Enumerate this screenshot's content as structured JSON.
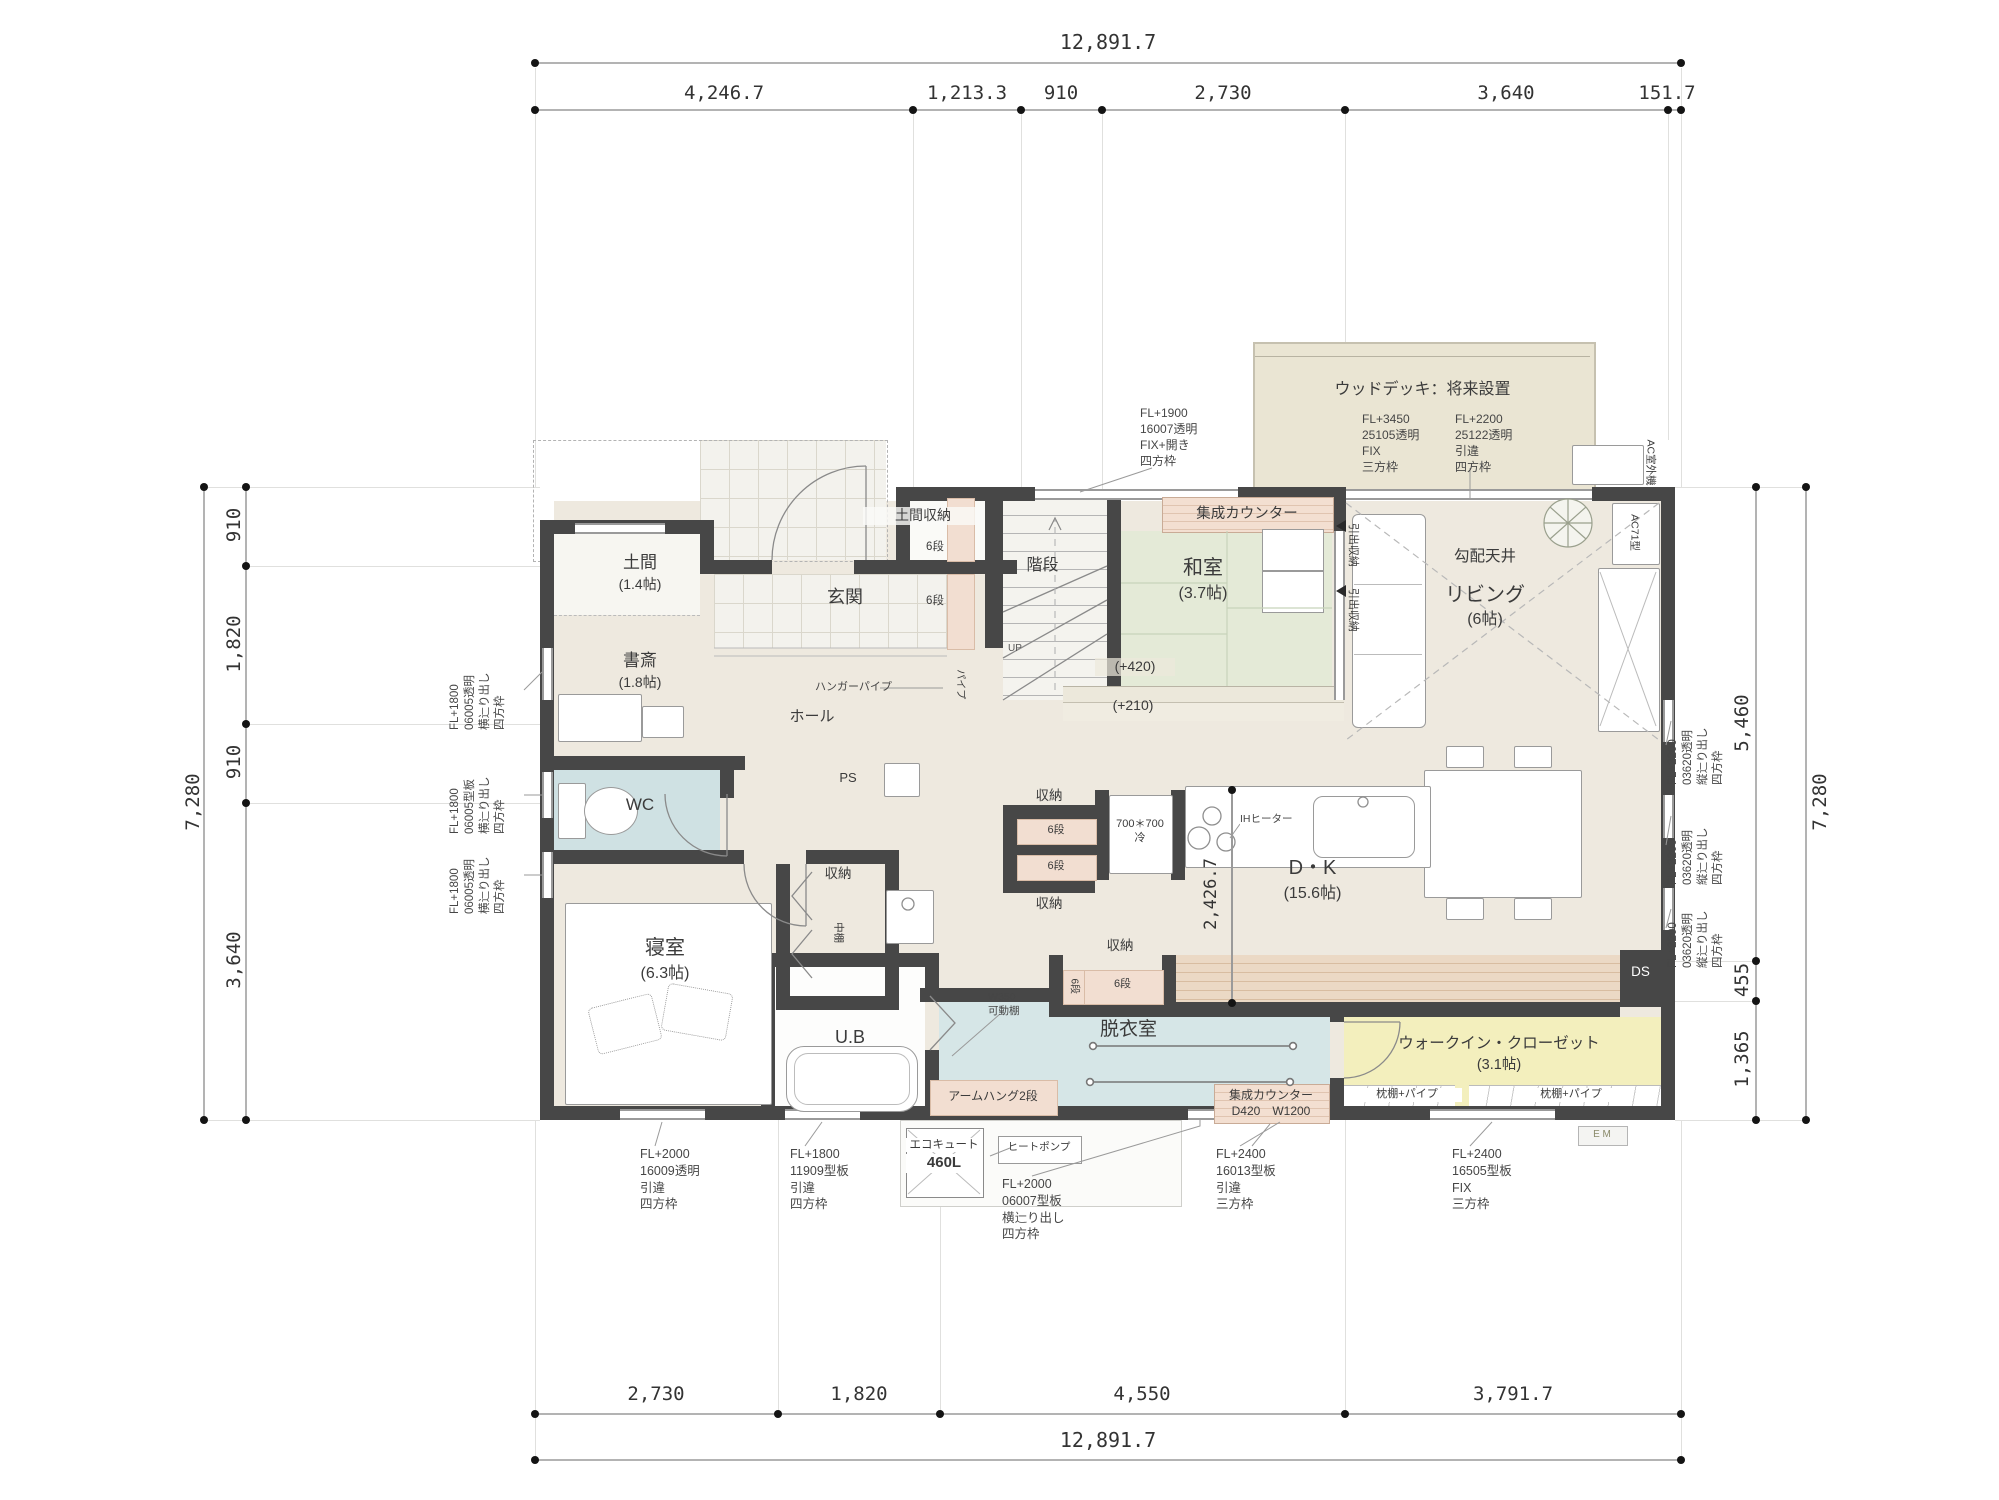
{
  "dims": {
    "top_total": "12,891.7",
    "top_segs": [
      "4,246.7",
      "1,213.3",
      "910",
      "2,730",
      "3,640",
      "151.7"
    ],
    "bottom_segs": [
      "2,730",
      "1,820",
      "4,550",
      "3,791.7"
    ],
    "bottom_total": "12,891.7",
    "left_total": "7,280",
    "left_segs": [
      "910",
      "1,820",
      "910",
      "3,640"
    ],
    "right_segs": [
      "5,460",
      "455",
      "1,365"
    ],
    "right_total": "7,280",
    "kitchen": "2,426.7"
  },
  "rooms": {
    "doma": "土間",
    "doma_size": "(1.4帖)",
    "study": "書斎",
    "study_size": "(1.8帖)",
    "genkan": "玄関",
    "doma_storage": "土間収納",
    "stairs": "階段",
    "up": "UP",
    "hall": "ホール",
    "hanger_pipe": "ハンガーパイプ",
    "pipe": "パイプ",
    "wc": "WC",
    "ps": "PS",
    "washitsu": "和室",
    "washitsu_size": "(3.7帖)",
    "level_420": "(+420)",
    "level_210": "(+210)",
    "counter": "集成カウンター",
    "drawer": "引出収納",
    "living": "リビング",
    "living_size": "(6帖)",
    "slope_ceiling": "勾配天井",
    "ac_unit": "AC71型",
    "ac_outdoor": "AC室外機",
    "deck_title": "ウッドデッキ：将来設置",
    "dk": "D・K",
    "dk_size": "(15.6帖)",
    "ih": "IHヒーター",
    "fridge": "700＊700\n冷",
    "storage": "収納",
    "shelf6": "6段",
    "naka_shelf": "中棚",
    "bedroom": "寝室",
    "bedroom_size": "(6.3帖)",
    "ub": "U.B",
    "w350": "W350\n可動棚",
    "armhang": "アームハング2段",
    "datsui": "脱衣室",
    "counter2": "集成カウンター\nD420　W1200",
    "wic": "ウォークイン・クローゼット",
    "wic_size": "(3.1帖)",
    "pillow_shelf": "枕棚+パイプ",
    "em": "E M",
    "ds": "DS",
    "ecocute": "エコキュート",
    "ecocute_size": "460L",
    "heatpump": "ヒートポンプ"
  },
  "windows": {
    "left1": "FL+1800\n06005透明\n横辷り出し\n四方枠",
    "left2": "FL+1800\n06005型板\n横辷り出し\n四方枠",
    "left3": "FL+1800\n06005透明\n横辷り出し\n四方枠",
    "right1": "FL+2200\n03620透明\n縦辷り出し\n四方枠",
    "right2": "FL+2200\n03620透明\n縦辷り出し\n四方枠",
    "right3": "FL+2200\n03620透明\n縦辷り出し\n四方枠",
    "top_stair": "FL+1900\n16007透明\nFIX+開き\n四方枠",
    "deck_fix": "FL+3450\n25105透明\nFIX\n三方枠",
    "deck_slide": "FL+2200\n25122透明\n引違\n四方枠",
    "bottom1": "FL+2000\n16009透明\n引違\n四方枠",
    "bottom2": "FL+1800\n11909型板\n引違\n四方枠",
    "bottom3": "FL+2000\n06007型板\n横辷り出し\n四方枠",
    "bottom4": "FL+2400\n16013型板\n引違\n三方枠",
    "bottom5": "FL+2400\n16505型板\nFIX\n三方枠"
  },
  "colors": {
    "wall": "#474747",
    "tatami": "#e4ead7",
    "wet_blue": "#cfe1e3",
    "datsui_blue": "#d6e6e7",
    "wic_yellow": "#f3efbd",
    "shelf_pink": "#f2ded1",
    "deck_beige": "#eae5d3",
    "floor_beige": "#eee9df"
  }
}
